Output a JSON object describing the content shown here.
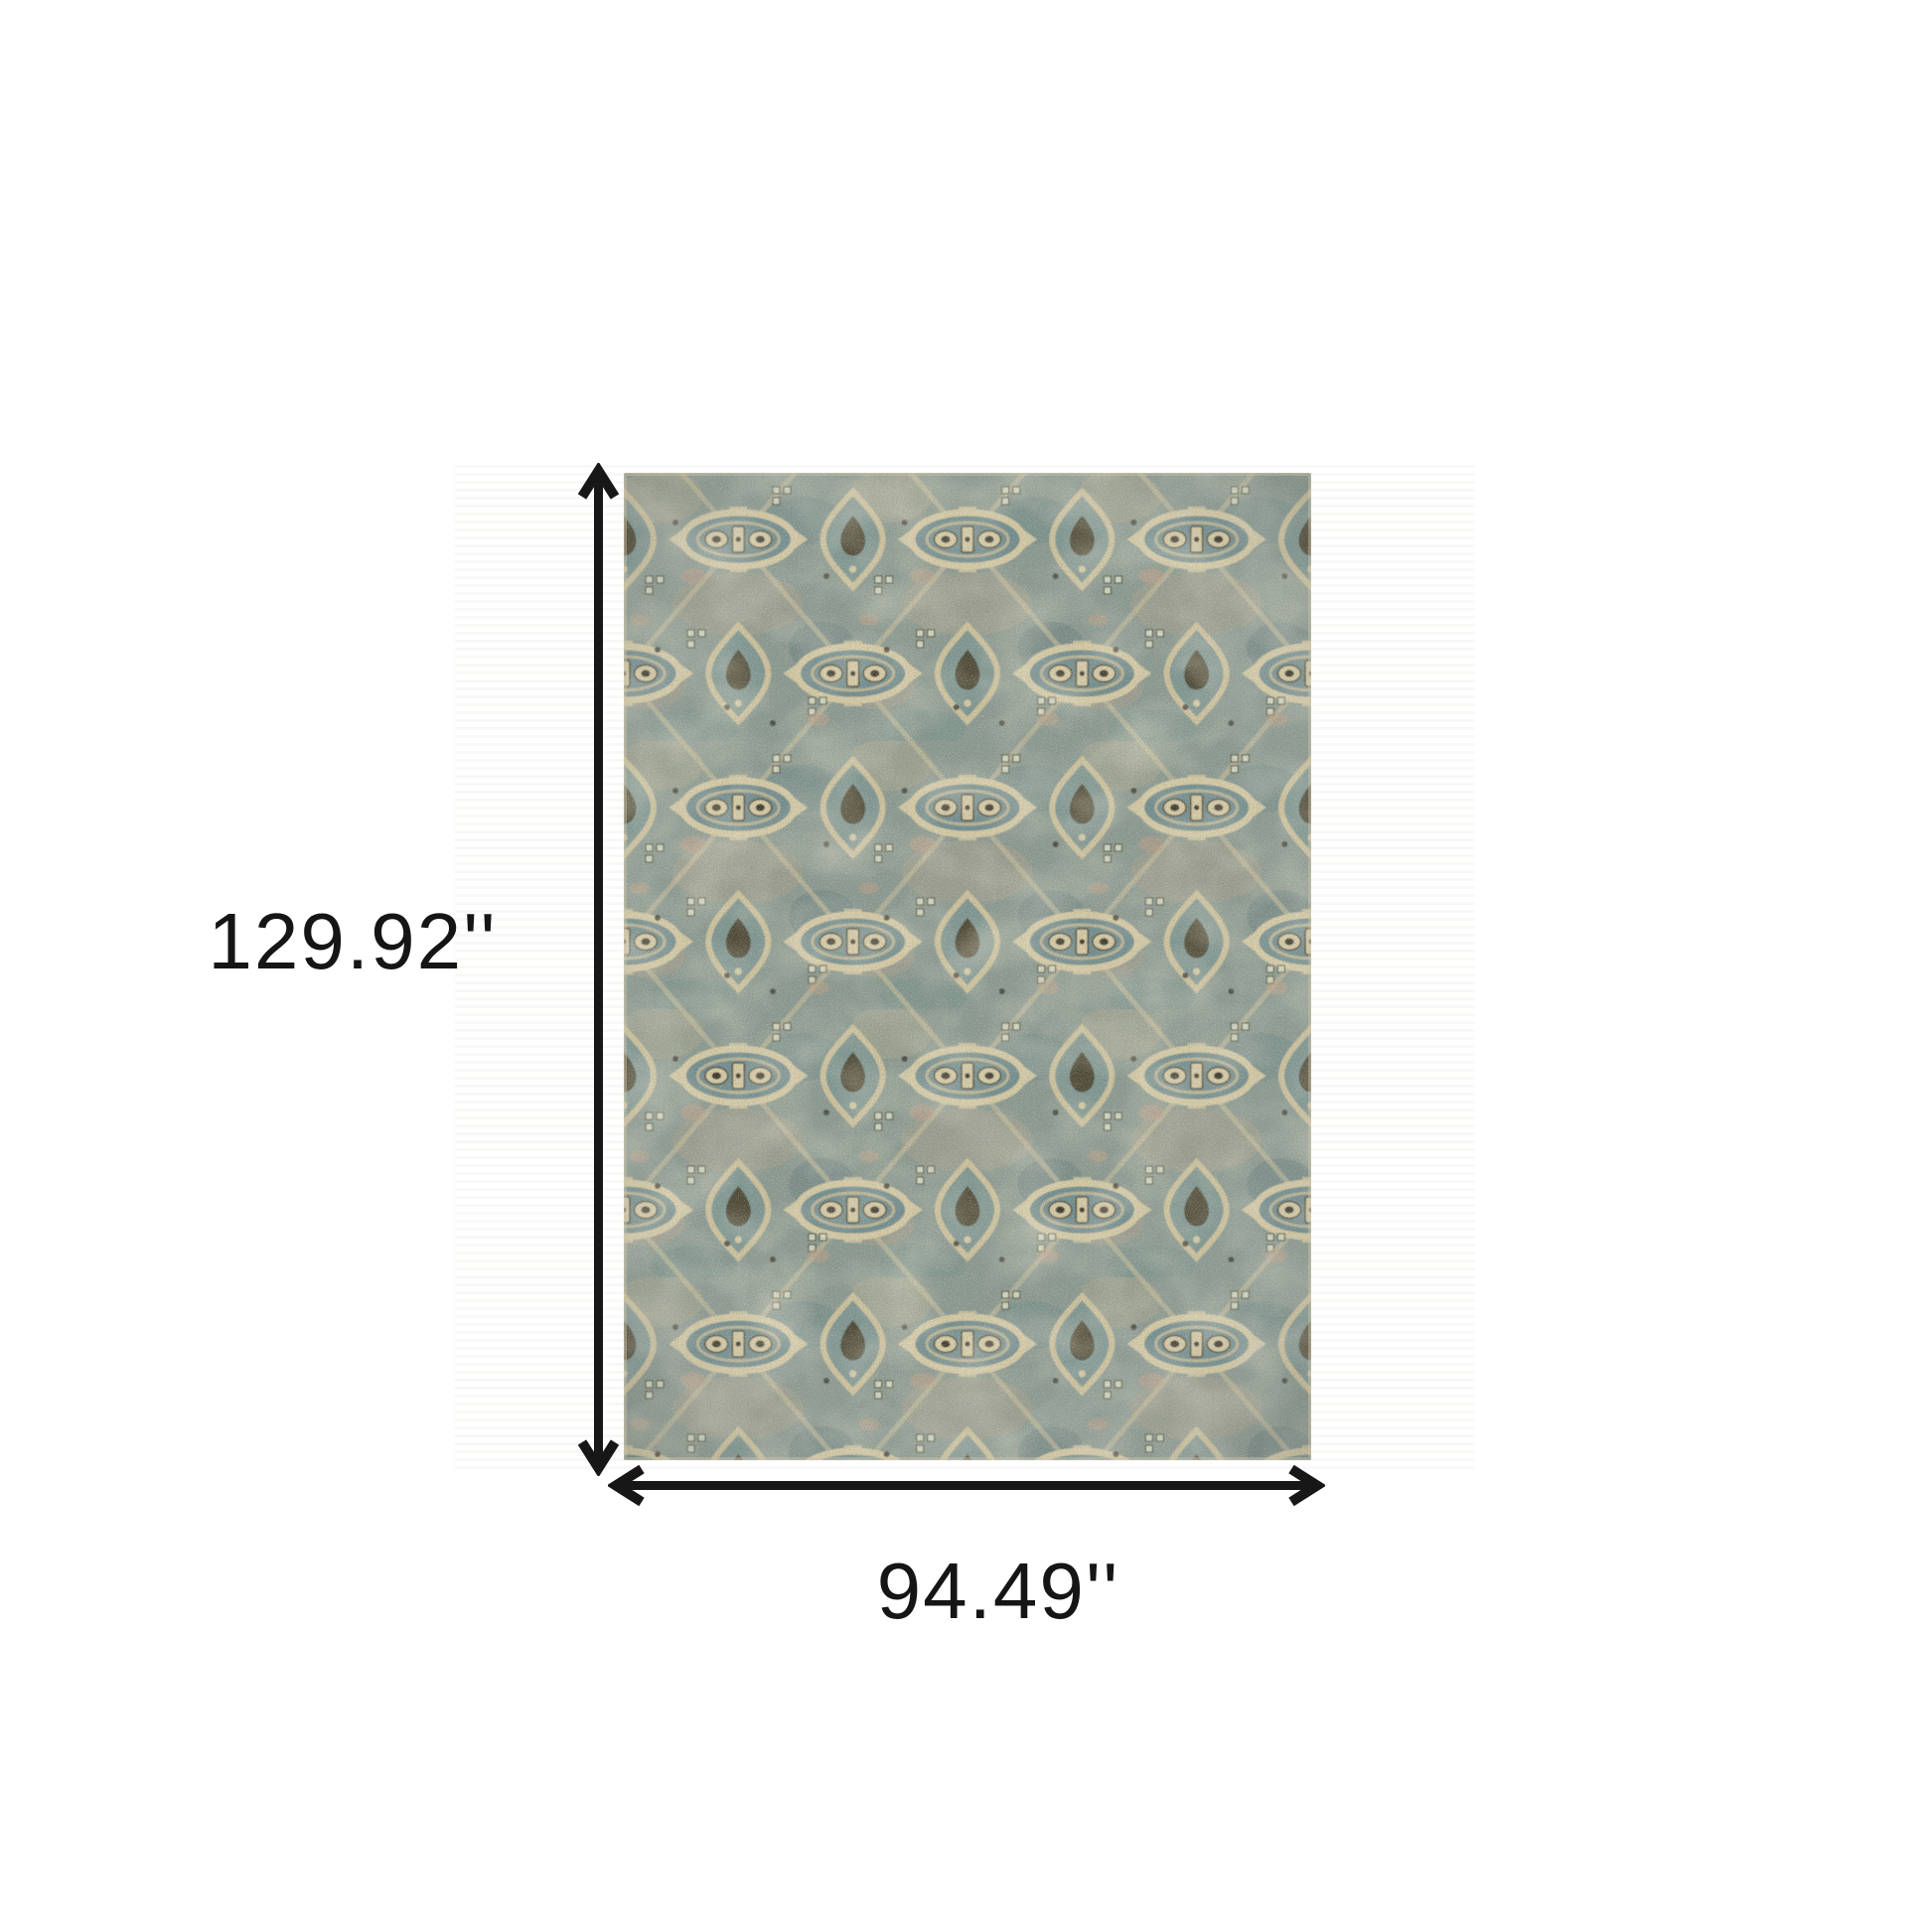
{
  "canvas": {
    "background": "#ffffff"
  },
  "labels": {
    "height": "129.92''",
    "width": "94.49''"
  },
  "arrow": {
    "color": "#171717"
  },
  "rug": {
    "palette": {
      "teal_base": "#8a9a92",
      "teal_field": "#6f8d90",
      "teal_deep": "#5f7b7d",
      "ivory": "#d8cda7",
      "cream": "#cfc49e",
      "tan": "#b2a68a",
      "salmon": "#bf9f86",
      "brown": "#4e4733",
      "espresso": "#352f24",
      "mint": "#d9e2cb"
    },
    "backdrop_stripe": "#f8f8f6"
  }
}
